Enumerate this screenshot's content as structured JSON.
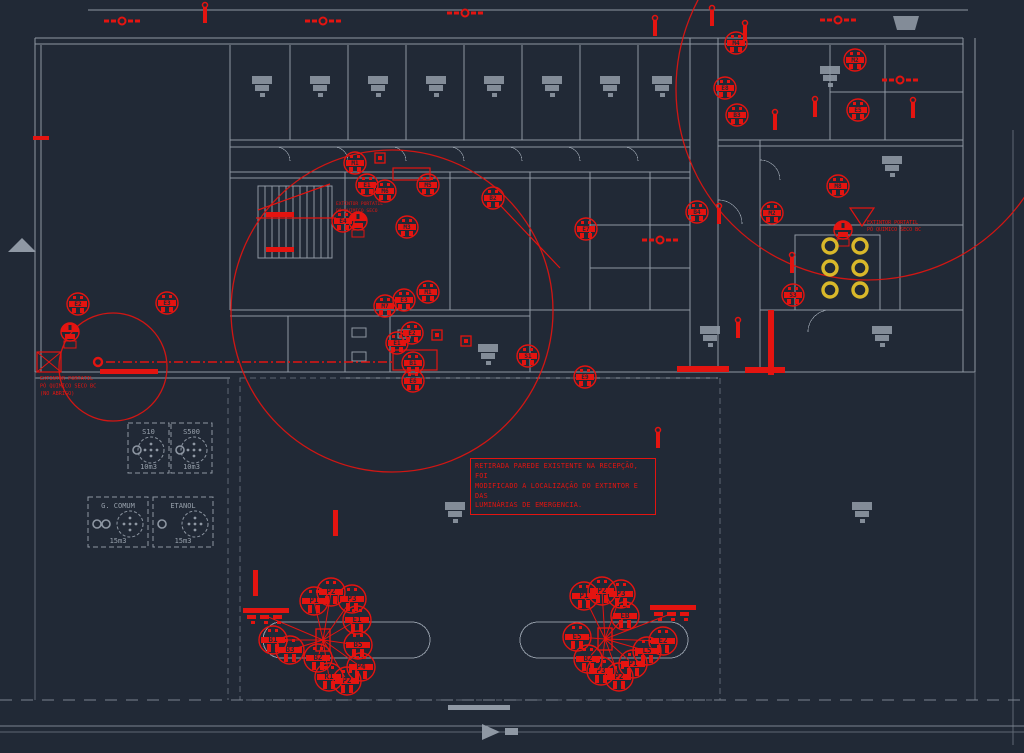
{
  "colors": {
    "background": "#212936",
    "wall": "#8e97a3",
    "wall_dim": "#5e6874",
    "furniture": "#8f98a4",
    "red": "#e41410",
    "yellow": "#d9b82a",
    "label_gray": "#97a0ab"
  },
  "annotation_box": {
    "lines": [
      "RETIRADA PAREDE EXISTENTE NA RECEPÇÃO, FOI",
      "MODIFICADO A LOCALIZAÇÃO DO EXTINTOR E DAS",
      "LUMINÁRIAS DE EMERGENCIA."
    ]
  },
  "notes": [
    {
      "name": "extinguisher-note-left",
      "x": 40,
      "y": 380,
      "size": 5.2,
      "lines": [
        "EXTINTOR PORTATIL",
        "PÓ QUIMICO SECO BC",
        "(NO ABRIGO)"
      ]
    },
    {
      "name": "extinguisher-note-top-right",
      "x": 867,
      "y": 224,
      "size": 5.0,
      "lines": [
        "EXTINTOR PORTATIL",
        "PÓ QUIMICO SECO BC"
      ]
    },
    {
      "name": "extinguisher-note-stairs",
      "x": 336,
      "y": 205,
      "size": 4.6,
      "lines": [
        "EXTINTOR PORTATIL",
        "PÓ QUIMICO SECO"
      ]
    }
  ],
  "tanks": [
    {
      "label": "S10",
      "volume": "10m3",
      "x": 128,
      "y": 423,
      "w": 41,
      "h": 50,
      "rings": 1
    },
    {
      "label": "S500",
      "volume": "10m3",
      "x": 171,
      "y": 423,
      "w": 41,
      "h": 50,
      "rings": 1
    },
    {
      "label": "G. COMUM",
      "volume": "15m3",
      "x": 88,
      "y": 497,
      "w": 60,
      "h": 50,
      "rings": 2
    },
    {
      "label": "ETANOL",
      "volume": "15m3",
      "x": 153,
      "y": 497,
      "w": 60,
      "h": 50,
      "rings": 1
    }
  ],
  "coverage_circles": [
    {
      "cx": 392,
      "cy": 311,
      "r": 161
    },
    {
      "cx": 867,
      "cy": 89,
      "r": 191
    },
    {
      "cx": 113,
      "cy": 367,
      "r": 54
    }
  ],
  "emergency_lights": [
    {
      "x": 355,
      "y": 163,
      "label": "M1"
    },
    {
      "x": 367,
      "y": 185,
      "label": "E1"
    },
    {
      "x": 385,
      "y": 191,
      "label": "M6"
    },
    {
      "x": 428,
      "y": 185,
      "label": "M5"
    },
    {
      "x": 343,
      "y": 221,
      "label": "E4"
    },
    {
      "x": 407,
      "y": 227,
      "label": "M3"
    },
    {
      "x": 428,
      "y": 292,
      "label": "M1"
    },
    {
      "x": 404,
      "y": 300,
      "label": "E3"
    },
    {
      "x": 385,
      "y": 306,
      "label": "M7"
    },
    {
      "x": 412,
      "y": 333,
      "label": "E2"
    },
    {
      "x": 397,
      "y": 343,
      "label": "E1"
    },
    {
      "x": 413,
      "y": 363,
      "label": "B1"
    },
    {
      "x": 413,
      "y": 381,
      "label": "E6"
    },
    {
      "x": 493,
      "y": 198,
      "label": "B2"
    },
    {
      "x": 586,
      "y": 229,
      "label": "E7"
    },
    {
      "x": 528,
      "y": 356,
      "label": "S1"
    },
    {
      "x": 585,
      "y": 377,
      "label": "E9"
    },
    {
      "x": 78,
      "y": 304,
      "label": "E2"
    },
    {
      "x": 167,
      "y": 303,
      "label": "E3"
    },
    {
      "x": 736,
      "y": 43,
      "label": "M4"
    },
    {
      "x": 725,
      "y": 88,
      "label": "E8"
    },
    {
      "x": 737,
      "y": 115,
      "label": "B3"
    },
    {
      "x": 855,
      "y": 60,
      "label": "M2"
    },
    {
      "x": 858,
      "y": 110,
      "label": "E5"
    },
    {
      "x": 838,
      "y": 186,
      "label": "M8"
    },
    {
      "x": 697,
      "y": 212,
      "label": "B4"
    },
    {
      "x": 772,
      "y": 213,
      "label": "M2"
    },
    {
      "x": 793,
      "y": 295,
      "label": "S3"
    }
  ],
  "extinguishers": [
    {
      "x": 70,
      "y": 332
    },
    {
      "x": 843,
      "y": 230
    },
    {
      "x": 358,
      "y": 221
    }
  ],
  "valves": [
    {
      "x": 122,
      "y": 21
    },
    {
      "x": 323,
      "y": 21
    },
    {
      "x": 465,
      "y": 13
    },
    {
      "x": 838,
      "y": 20
    },
    {
      "x": 900,
      "y": 80
    },
    {
      "x": 660,
      "y": 240
    }
  ],
  "risers": [
    {
      "x": 205,
      "y": 15
    },
    {
      "x": 655,
      "y": 28
    },
    {
      "x": 712,
      "y": 18
    },
    {
      "x": 745,
      "y": 33
    },
    {
      "x": 775,
      "y": 122
    },
    {
      "x": 815,
      "y": 109
    },
    {
      "x": 913,
      "y": 110
    },
    {
      "x": 719,
      "y": 216
    },
    {
      "x": 792,
      "y": 265
    },
    {
      "x": 738,
      "y": 330
    },
    {
      "x": 658,
      "y": 440
    }
  ],
  "squares": [
    {
      "x": 380,
      "y": 158
    },
    {
      "x": 437,
      "y": 335
    },
    {
      "x": 466,
      "y": 341
    }
  ],
  "red_boxes": [
    {
      "x": 37,
      "y": 352,
      "w": 24,
      "h": 20,
      "cross": true
    },
    {
      "x": 393,
      "y": 350,
      "w": 44,
      "h": 20,
      "cross": false
    },
    {
      "x": 393,
      "y": 168,
      "w": 37,
      "h": 12,
      "cross": false
    }
  ],
  "red_strips": [
    {
      "x": 100,
      "y": 369,
      "w": 58,
      "h": 5
    },
    {
      "x": 677,
      "y": 366,
      "w": 52,
      "h": 6
    },
    {
      "x": 745,
      "y": 367,
      "w": 40,
      "h": 6
    },
    {
      "x": 768,
      "y": 310,
      "w": 6,
      "h": 65
    },
    {
      "x": 333,
      "y": 510,
      "w": 5,
      "h": 26
    },
    {
      "x": 253,
      "y": 570,
      "w": 5,
      "h": 26
    },
    {
      "x": 266,
      "y": 212,
      "w": 28,
      "h": 5
    },
    {
      "x": 266,
      "y": 247,
      "w": 28,
      "h": 5
    },
    {
      "x": 33,
      "y": 136,
      "w": 16,
      "h": 4
    }
  ],
  "red_lines": [
    {
      "x1": 256,
      "y1": 218,
      "x2": 336,
      "y2": 218
    },
    {
      "x1": 258,
      "y1": 210,
      "x2": 330,
      "y2": 184
    },
    {
      "x1": 500,
      "y1": 205,
      "x2": 560,
      "y2": 268
    }
  ],
  "red_triangles": [
    {
      "points": "850,208 874,208 862,226"
    }
  ],
  "dash_line": {
    "x1": 106,
    "y1": 362,
    "x2": 392,
    "y2": 362,
    "donut_x": 98,
    "donut_y": 362
  },
  "yellow_cylinders": [
    {
      "x": 830,
      "y": 246
    },
    {
      "x": 860,
      "y": 246
    },
    {
      "x": 830,
      "y": 268
    },
    {
      "x": 860,
      "y": 268
    },
    {
      "x": 830,
      "y": 290
    },
    {
      "x": 860,
      "y": 290
    }
  ],
  "pump_clusters": [
    {
      "hub": {
        "x": 323,
        "y": 640
      },
      "dispenser": {
        "x": 243,
        "y": 608
      },
      "tags": [
        {
          "x": 314,
          "y": 601,
          "label": "P1"
        },
        {
          "x": 331,
          "y": 592,
          "label": "P2"
        },
        {
          "x": 352,
          "y": 599,
          "label": "P3"
        },
        {
          "x": 357,
          "y": 620,
          "label": "E1"
        },
        {
          "x": 358,
          "y": 645,
          "label": "B5"
        },
        {
          "x": 361,
          "y": 667,
          "label": "P4"
        },
        {
          "x": 347,
          "y": 681,
          "label": "P2"
        },
        {
          "x": 329,
          "y": 677,
          "label": "R1"
        },
        {
          "x": 318,
          "y": 658,
          "label": "B2"
        },
        {
          "x": 290,
          "y": 650,
          "label": "B3"
        },
        {
          "x": 273,
          "y": 640,
          "label": "B1"
        }
      ]
    },
    {
      "hub": {
        "x": 605,
        "y": 639
      },
      "dispenser": {
        "x": 650,
        "y": 605
      },
      "tags": [
        {
          "x": 584,
          "y": 596,
          "label": "P1"
        },
        {
          "x": 602,
          "y": 591,
          "label": "P2"
        },
        {
          "x": 621,
          "y": 594,
          "label": "P3"
        },
        {
          "x": 625,
          "y": 616,
          "label": "EB"
        },
        {
          "x": 663,
          "y": 641,
          "label": "E2"
        },
        {
          "x": 647,
          "y": 651,
          "label": "L5"
        },
        {
          "x": 633,
          "y": 664,
          "label": "P1"
        },
        {
          "x": 619,
          "y": 677,
          "label": "P2"
        },
        {
          "x": 601,
          "y": 671,
          "label": "P3"
        },
        {
          "x": 588,
          "y": 659,
          "label": "B2"
        },
        {
          "x": 577,
          "y": 637,
          "label": "E5"
        }
      ]
    }
  ]
}
